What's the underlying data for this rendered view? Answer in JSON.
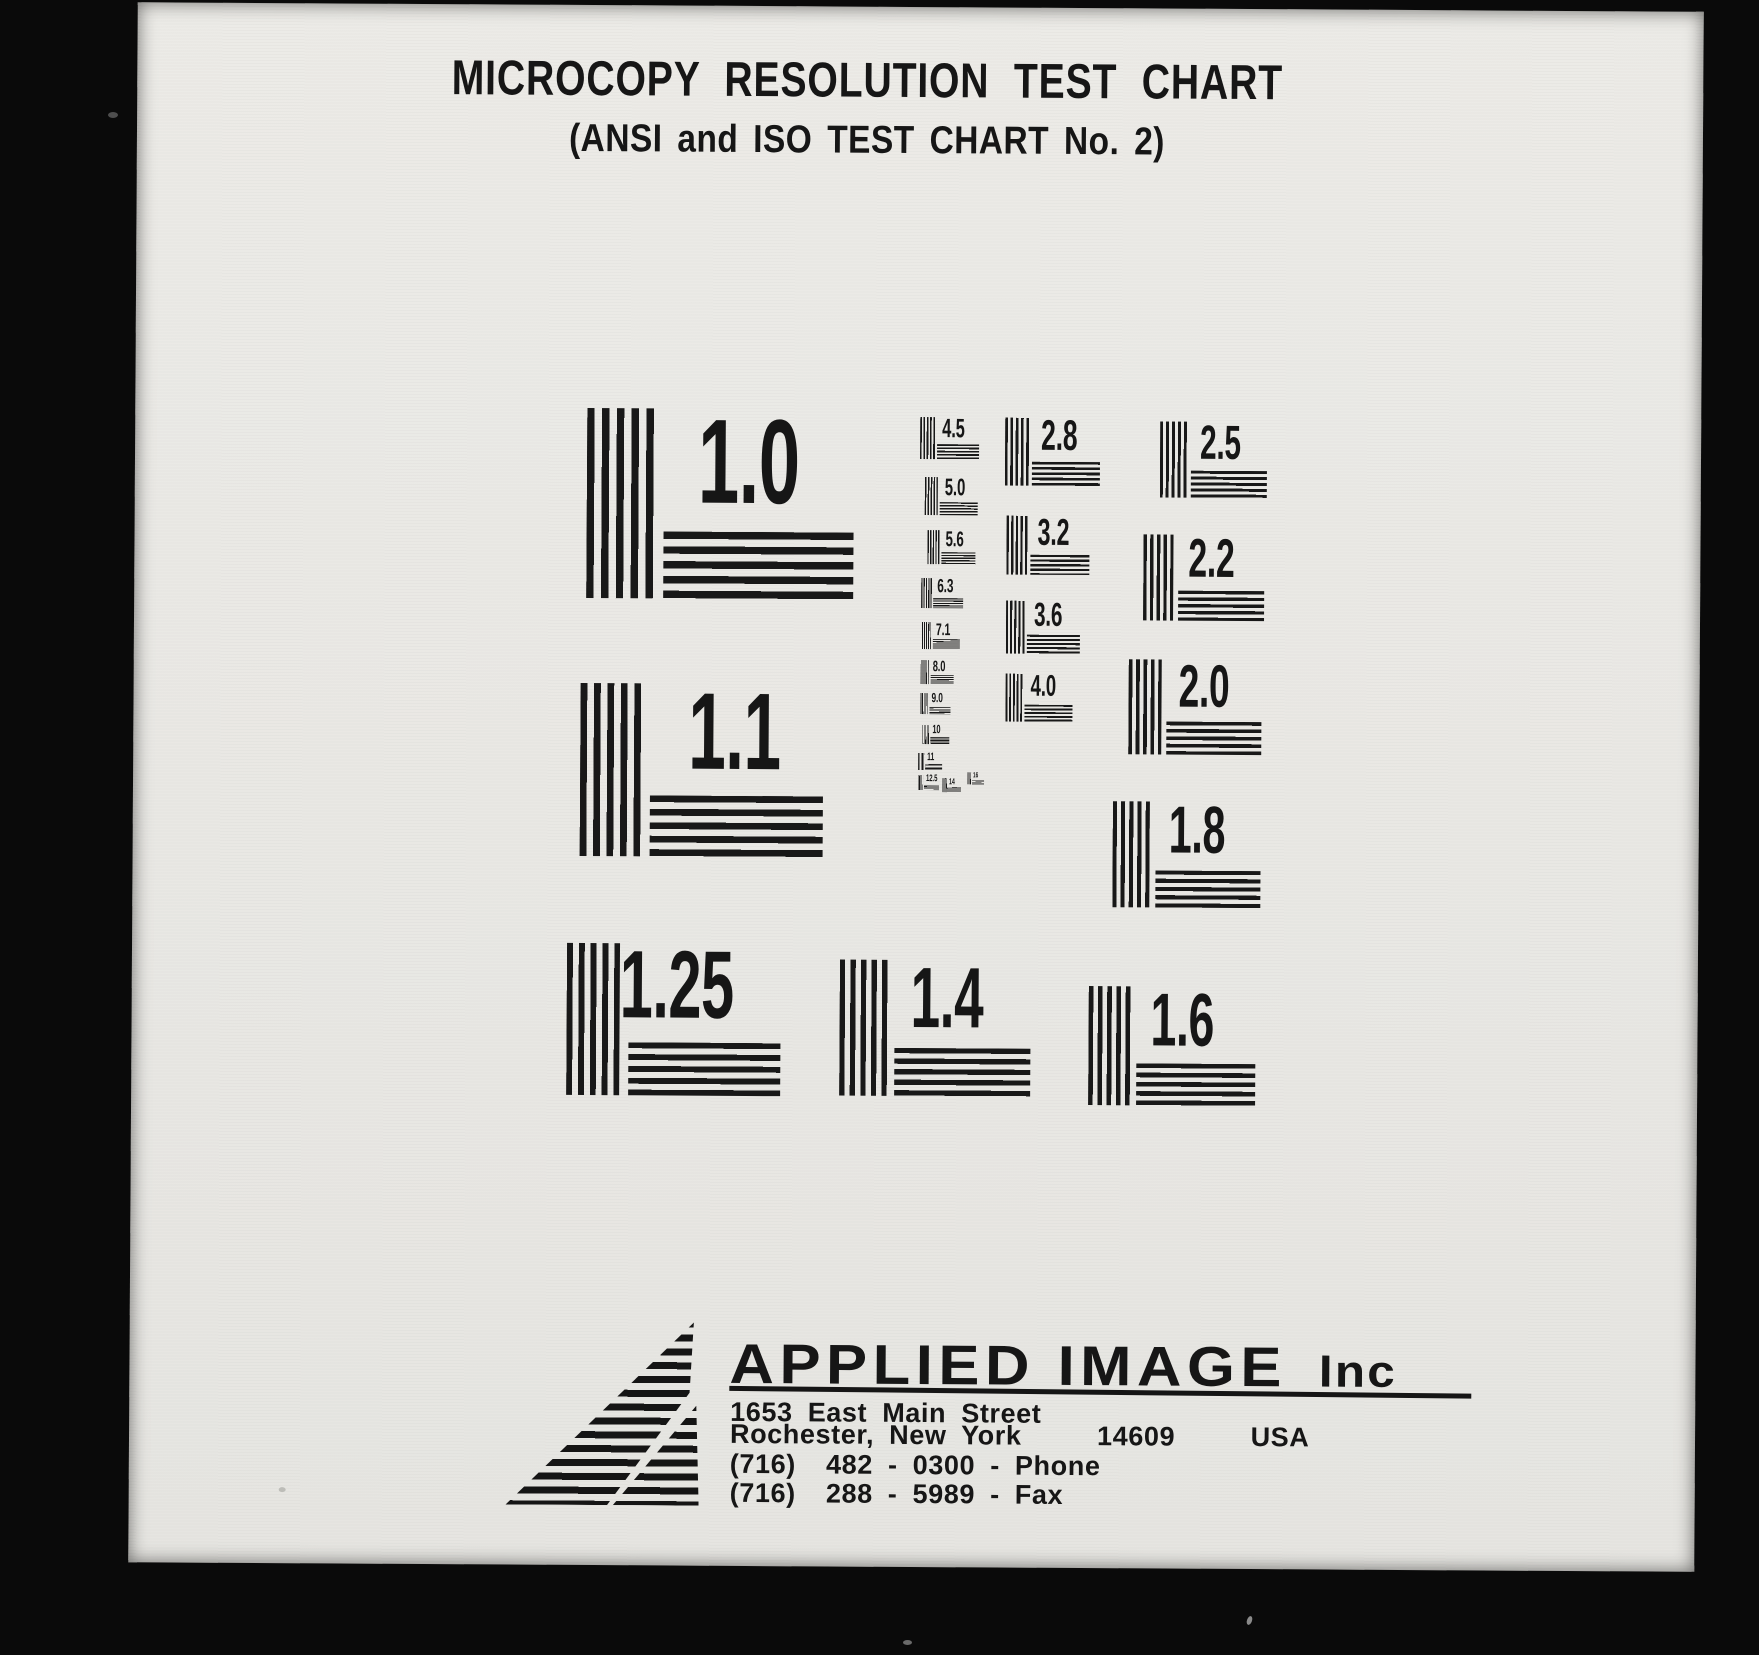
{
  "header": {
    "title": "MICROCOPY RESOLUTION TEST CHART",
    "subtitle": "(ANSI and ISO TEST CHART No. 2)"
  },
  "patterns": [
    {
      "label": "1.0"
    },
    {
      "label": "1.1"
    },
    {
      "label": "1.25"
    },
    {
      "label": "1.4"
    },
    {
      "label": "1.6"
    },
    {
      "label": "1.8"
    },
    {
      "label": "2.0"
    },
    {
      "label": "2.2"
    },
    {
      "label": "2.5"
    },
    {
      "label": "2.8"
    },
    {
      "label": "3.2"
    },
    {
      "label": "3.6"
    },
    {
      "label": "4.0"
    },
    {
      "label": "4.5"
    },
    {
      "label": "5.0"
    },
    {
      "label": "5.6"
    },
    {
      "label": "6.3"
    },
    {
      "label": "7.1"
    },
    {
      "label": "8.0"
    },
    {
      "label": "9.0"
    },
    {
      "label": "10"
    },
    {
      "label": "11"
    },
    {
      "label": "12.5"
    },
    {
      "label": "14"
    },
    {
      "label": "16"
    }
  ],
  "footer": {
    "company": "APPLIED IMAGE",
    "company_suffix": "  Inc",
    "address_line1": "1653 East Main Street",
    "address_line2": "Rochester, New York     14609     USA",
    "phone_line": "(716)  482 - 0300 - Phone",
    "fax_line": "(716)  288 - 5989 - Fax"
  },
  "colors": {
    "ink": "#161616",
    "paper": "#e9e8e4",
    "background": "#0a0a0a"
  }
}
